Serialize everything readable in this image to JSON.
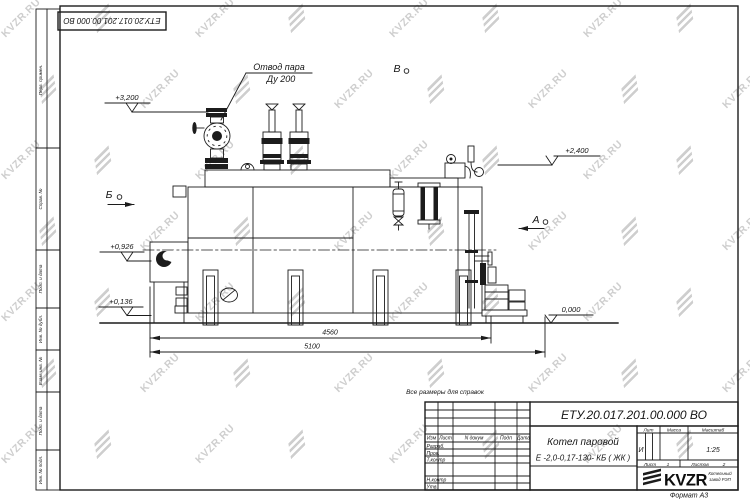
{
  "watermark": {
    "text": "KVZR.RU"
  },
  "frame": {
    "stamp_top": "ЕТУ.20.017.201.00.000  ВО",
    "cols": {
      "perv": "Перв. примен.",
      "sprav": "Справ. №",
      "podp1": "Подп. и дата",
      "inv_dubl": "Инв. № дубл.",
      "vzam": "Взам. инв. №",
      "podp2": "Подп. и дата",
      "inv_podl": "Инв. № подл."
    }
  },
  "drawing": {
    "steam_note_l1": "Отвод пара",
    "steam_note_l2": "Ду 200",
    "lev_3200": "+3,200",
    "lev_2400": "+2,400",
    "lev_0926": "+0,926",
    "lev_0136": "+0,136",
    "lev_0000": "0,000",
    "dim_inner": "4560",
    "dim_outer": "5100",
    "view_b": "Б",
    "view_v": "В",
    "view_a": "А",
    "note": "Все размеры для справок"
  },
  "title_block": {
    "designation": "ЕТУ.20.017.201.00.000  ВО",
    "product_l1": "Котел паровой",
    "product_l2": "Е -2,0-0,17-130- КБ ( ЖК )",
    "h_izm": "Изм",
    "h_list": "Лист",
    "h_ndok": "N докум",
    "h_podp": "Подп",
    "h_data": "Дата",
    "r_razrab": "Разраб.",
    "r_prov": "Пров.",
    "r_tkontr": "Т.контр",
    "r_nkontr": "Н.контр",
    "r_utv": "Утв.",
    "lit_label": "Лит",
    "lit_value": "И",
    "massa_label": "Масса",
    "scale_label": "Масштаб",
    "scale_value": "1:25",
    "sheet_label": "Лист",
    "sheet_value": "1",
    "sheets_label": "Листов",
    "sheets_value": "2",
    "brand": "KVZR",
    "brand_sub1": "Котельный",
    "brand_sub2": "завод РЭП",
    "format": "Формат А3"
  }
}
